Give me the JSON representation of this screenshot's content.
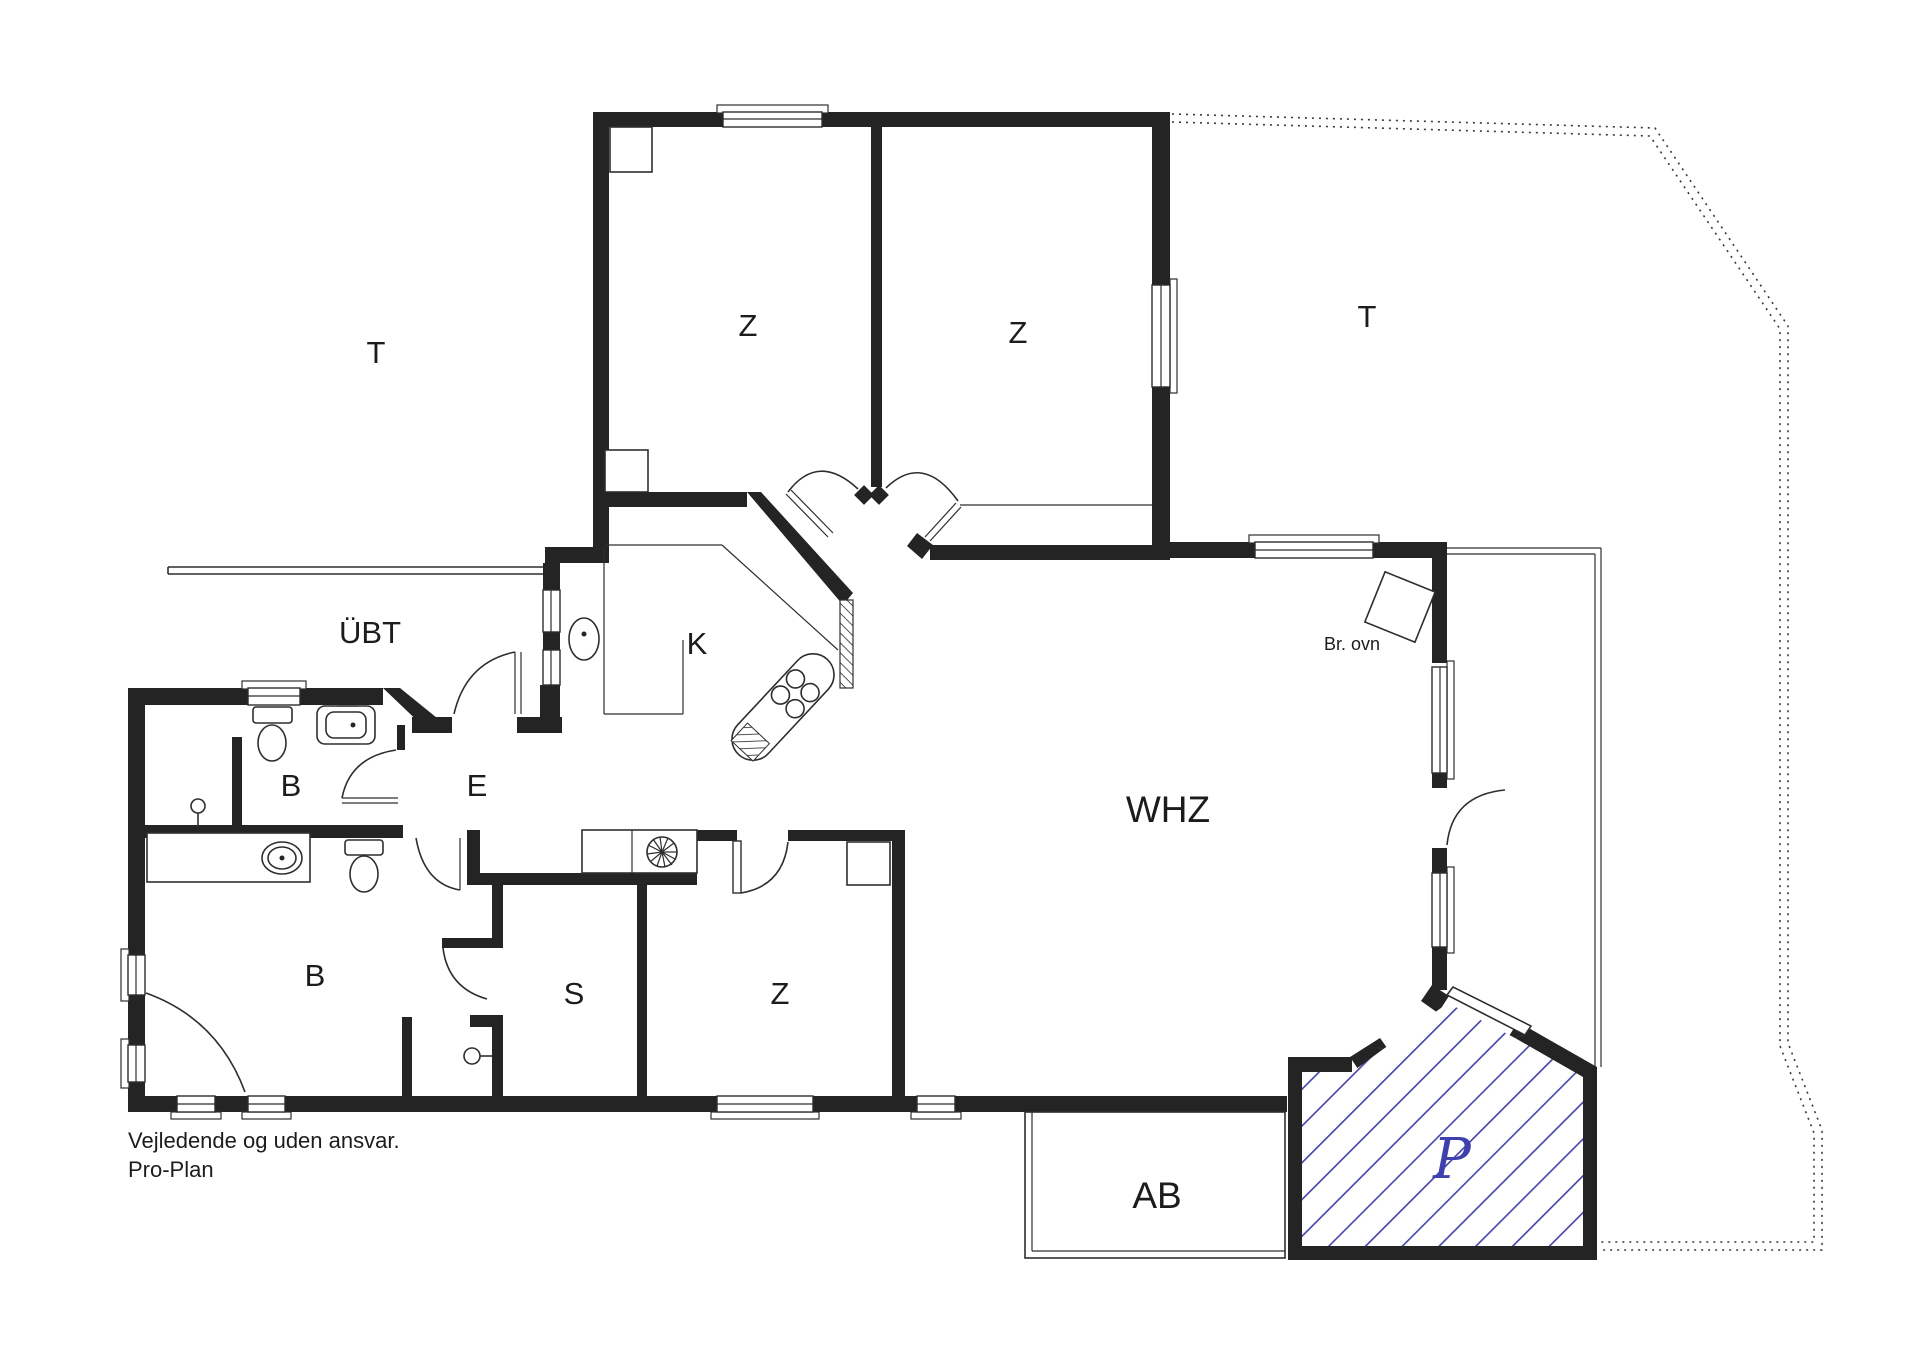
{
  "title": "Floor plan",
  "colors": {
    "wall": "#242424",
    "line": "#2e2e2e",
    "hatch_blue": "#4444aa",
    "parking_label_blue": "#3f3fae",
    "background": "#ffffff"
  },
  "rooms": {
    "terrace_left": "T",
    "bedroom_top_left": "Z",
    "bedroom_top_right": "Z",
    "terrace_right": "T",
    "covered_terrace": "ÜBT",
    "kitchen": "K",
    "hall": "E",
    "bath_small": "B",
    "living_room": "WHZ",
    "bath_large": "B",
    "storage": "S",
    "bedroom_bottom": "Z",
    "annex": "AB",
    "parking": "P"
  },
  "annotations": {
    "wood_stove": "Br. ovn"
  },
  "footer": {
    "line1": "Vejledende og uden ansvar.",
    "line2": "Pro-Plan"
  }
}
